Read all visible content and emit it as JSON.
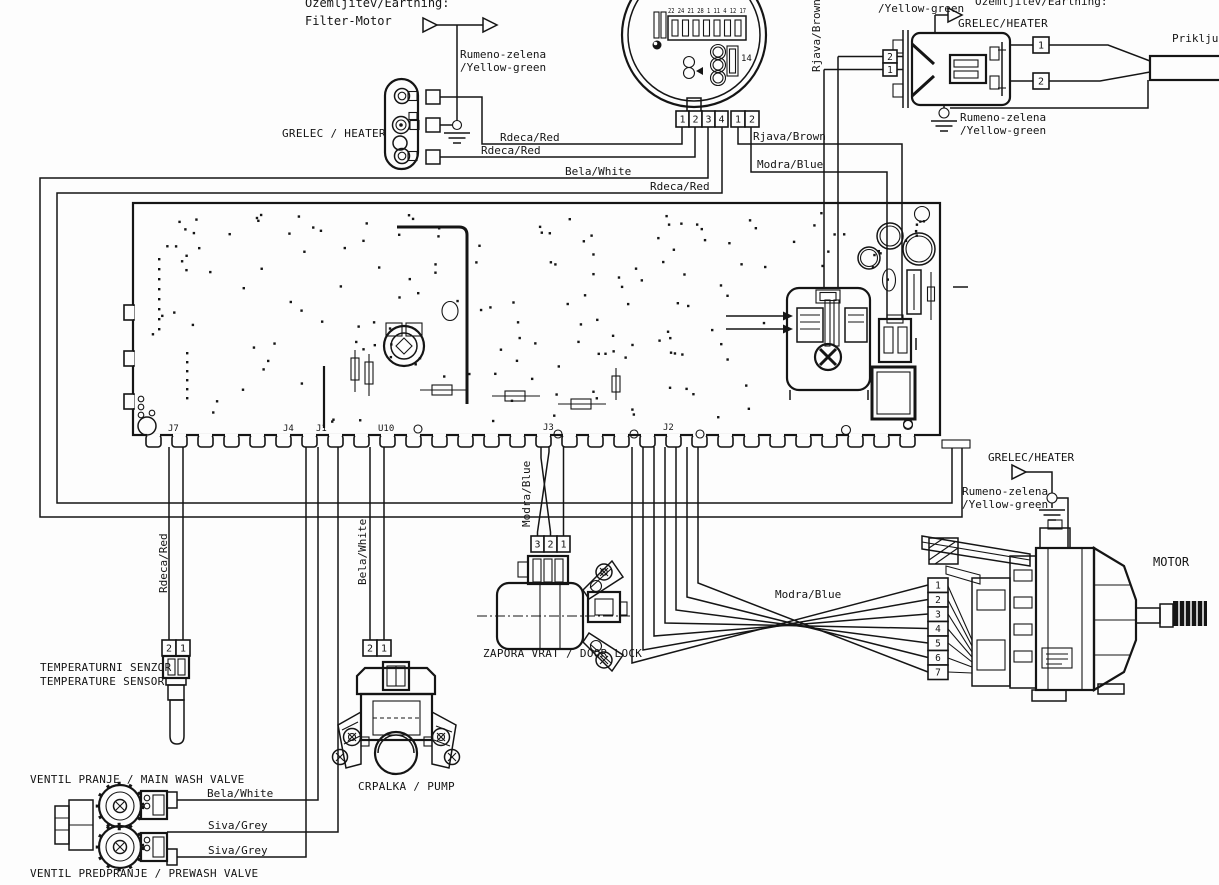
{
  "colors": {
    "ink": "#151515",
    "paper": "#fdfdfd"
  },
  "top_left": {
    "earthing_line1": "Ozemljitev/Earthing:",
    "earthing_line2": "Filter-Motor",
    "yg1": "Rumeno-zelena",
    "yg2": "/Yellow-green"
  },
  "heater_left": {
    "label": "GRELEC / HEATER"
  },
  "wires": {
    "red": "Rdeca/Red",
    "white": "Bela/White",
    "brown": "Rjava/Brown",
    "blue": "Modra/Blue",
    "grey": "Siva/Grey"
  },
  "pressure_switch": {
    "row_numbers": "22 24 21 28 1 11 4 12 17",
    "pin14": "14",
    "block_a": [
      "1",
      "2",
      "3",
      "4"
    ],
    "block_b": [
      "1",
      "2"
    ]
  },
  "top_right": {
    "yg_clipped": "/Yellow-green",
    "earthing": "Ozemljitev/Earthing:",
    "heater": "GRELEC/HEATER",
    "yg1": "Rumeno-zelena",
    "yg2": "/Yellow-green",
    "cord": "Priklju",
    "boxes_left": [
      "2",
      "1"
    ],
    "boxes_right": [
      "1",
      "2"
    ]
  },
  "pcb": {
    "connectors": [
      "J7",
      "J4",
      "J1",
      "U10",
      "J3",
      "J2"
    ]
  },
  "temp_sensor": {
    "l1": "TEMPERATURNI SENZOR",
    "l2": "TEMPERATURE SENSOR",
    "pins": [
      "2",
      "1"
    ]
  },
  "valves": {
    "main": "VENTIL PRANJE / MAIN WASH VALVE",
    "prewash": "VENTIL PREDPRANJE / PREWASH VALVE"
  },
  "pump": {
    "label": "CRPALKA / PUMP",
    "pins": [
      "2",
      "1"
    ]
  },
  "door_lock": {
    "label": "ZAPORA VRAT / DOOR LOCK",
    "pins": [
      "3",
      "2",
      "1"
    ]
  },
  "motor": {
    "label": "MOTOR",
    "heater_ref": "GRELEC/HEATER",
    "yg1": "Rumeno-zelena",
    "yg2": "/Yellow-green",
    "pins": [
      "1",
      "2",
      "3",
      "4",
      "5",
      "6",
      "7"
    ]
  }
}
